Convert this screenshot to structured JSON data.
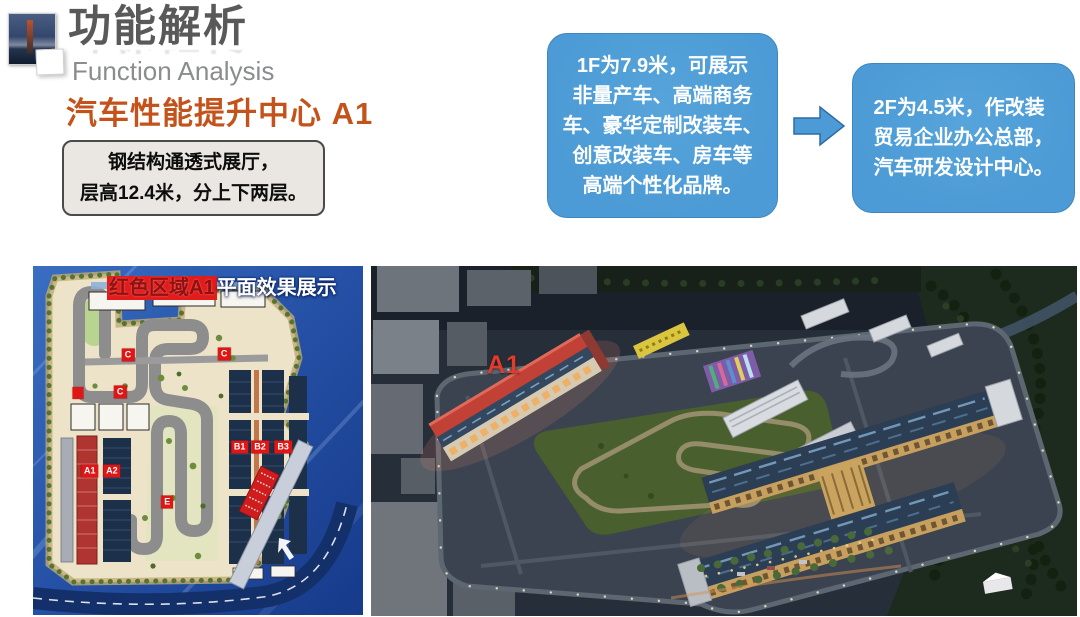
{
  "slide": {
    "title": "功能解析",
    "subtitle": "Function Analysis",
    "heading": "汽车性能提升中心 A1"
  },
  "note_box": {
    "lines": [
      "钢结构通透式展厅，",
      "层高12.4米，分上下两层。"
    ]
  },
  "callouts": {
    "floor1": {
      "lines": [
        "1F为7.9米，可展示",
        "非量产车、高端商务",
        "车、豪华定制改装车、",
        "创意改装车、房车等",
        "高端个性化品牌。"
      ]
    },
    "floor2": {
      "lines": [
        "2F为4.5米，作改装",
        "贸易企业办公总部，",
        "汽车研发设计中心。"
      ]
    }
  },
  "site_plan": {
    "caption_highlight": "红色区域A1",
    "caption_rest": "平面效果展示",
    "labels": [
      {
        "text": "C",
        "x": 28.8,
        "y": 25.5
      },
      {
        "text": "C",
        "x": 57.9,
        "y": 25.2
      },
      {
        "text": "",
        "x": 13.6,
        "y": 36.3
      },
      {
        "text": "C",
        "x": 26.4,
        "y": 36.0
      },
      {
        "text": "A1",
        "x": 17.2,
        "y": 58.6
      },
      {
        "text": "A2",
        "x": 23.9,
        "y": 58.6
      },
      {
        "text": "B1",
        "x": 62.6,
        "y": 51.8
      },
      {
        "text": "B2",
        "x": 68.8,
        "y": 51.8
      },
      {
        "text": "B3",
        "x": 75.8,
        "y": 51.8
      },
      {
        "text": "E",
        "x": 40.7,
        "y": 67.6
      }
    ]
  },
  "aerial": {
    "label": "A1"
  },
  "colors": {
    "accent_blue": "#4d9bd6",
    "heading_orange": "#c4531b",
    "tag_red": "#e01515",
    "title_gray": "#595959",
    "subtitle_gray": "#8a8c8e"
  }
}
